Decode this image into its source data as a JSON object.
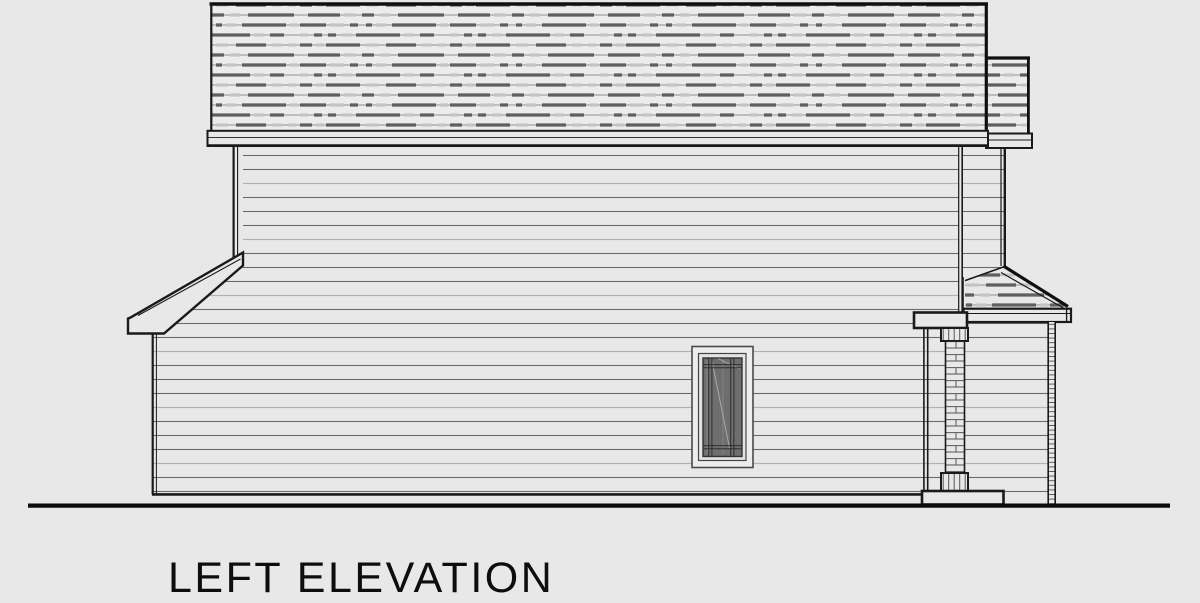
{
  "drawing": {
    "title": "LEFT ELEVATION",
    "type_note": "architectural side elevation drawing of a two-story house with shed porch roofs, lap siding, brick porch pier and single casement window"
  },
  "colors": {
    "paper": "#e8e8e8",
    "ink": "#1a1a1a",
    "siding_line": "#6a6a6a",
    "siding_line_light": "#b2b2b2",
    "shingle_dark": "#5f5f5f",
    "shingle_light": "#c4c4c4",
    "shingle_base": "#8f8f8f",
    "glass": "#6e6e6e",
    "muntin": "#2e2e2e",
    "frame": "#ededed",
    "brick_line": "#555555"
  }
}
